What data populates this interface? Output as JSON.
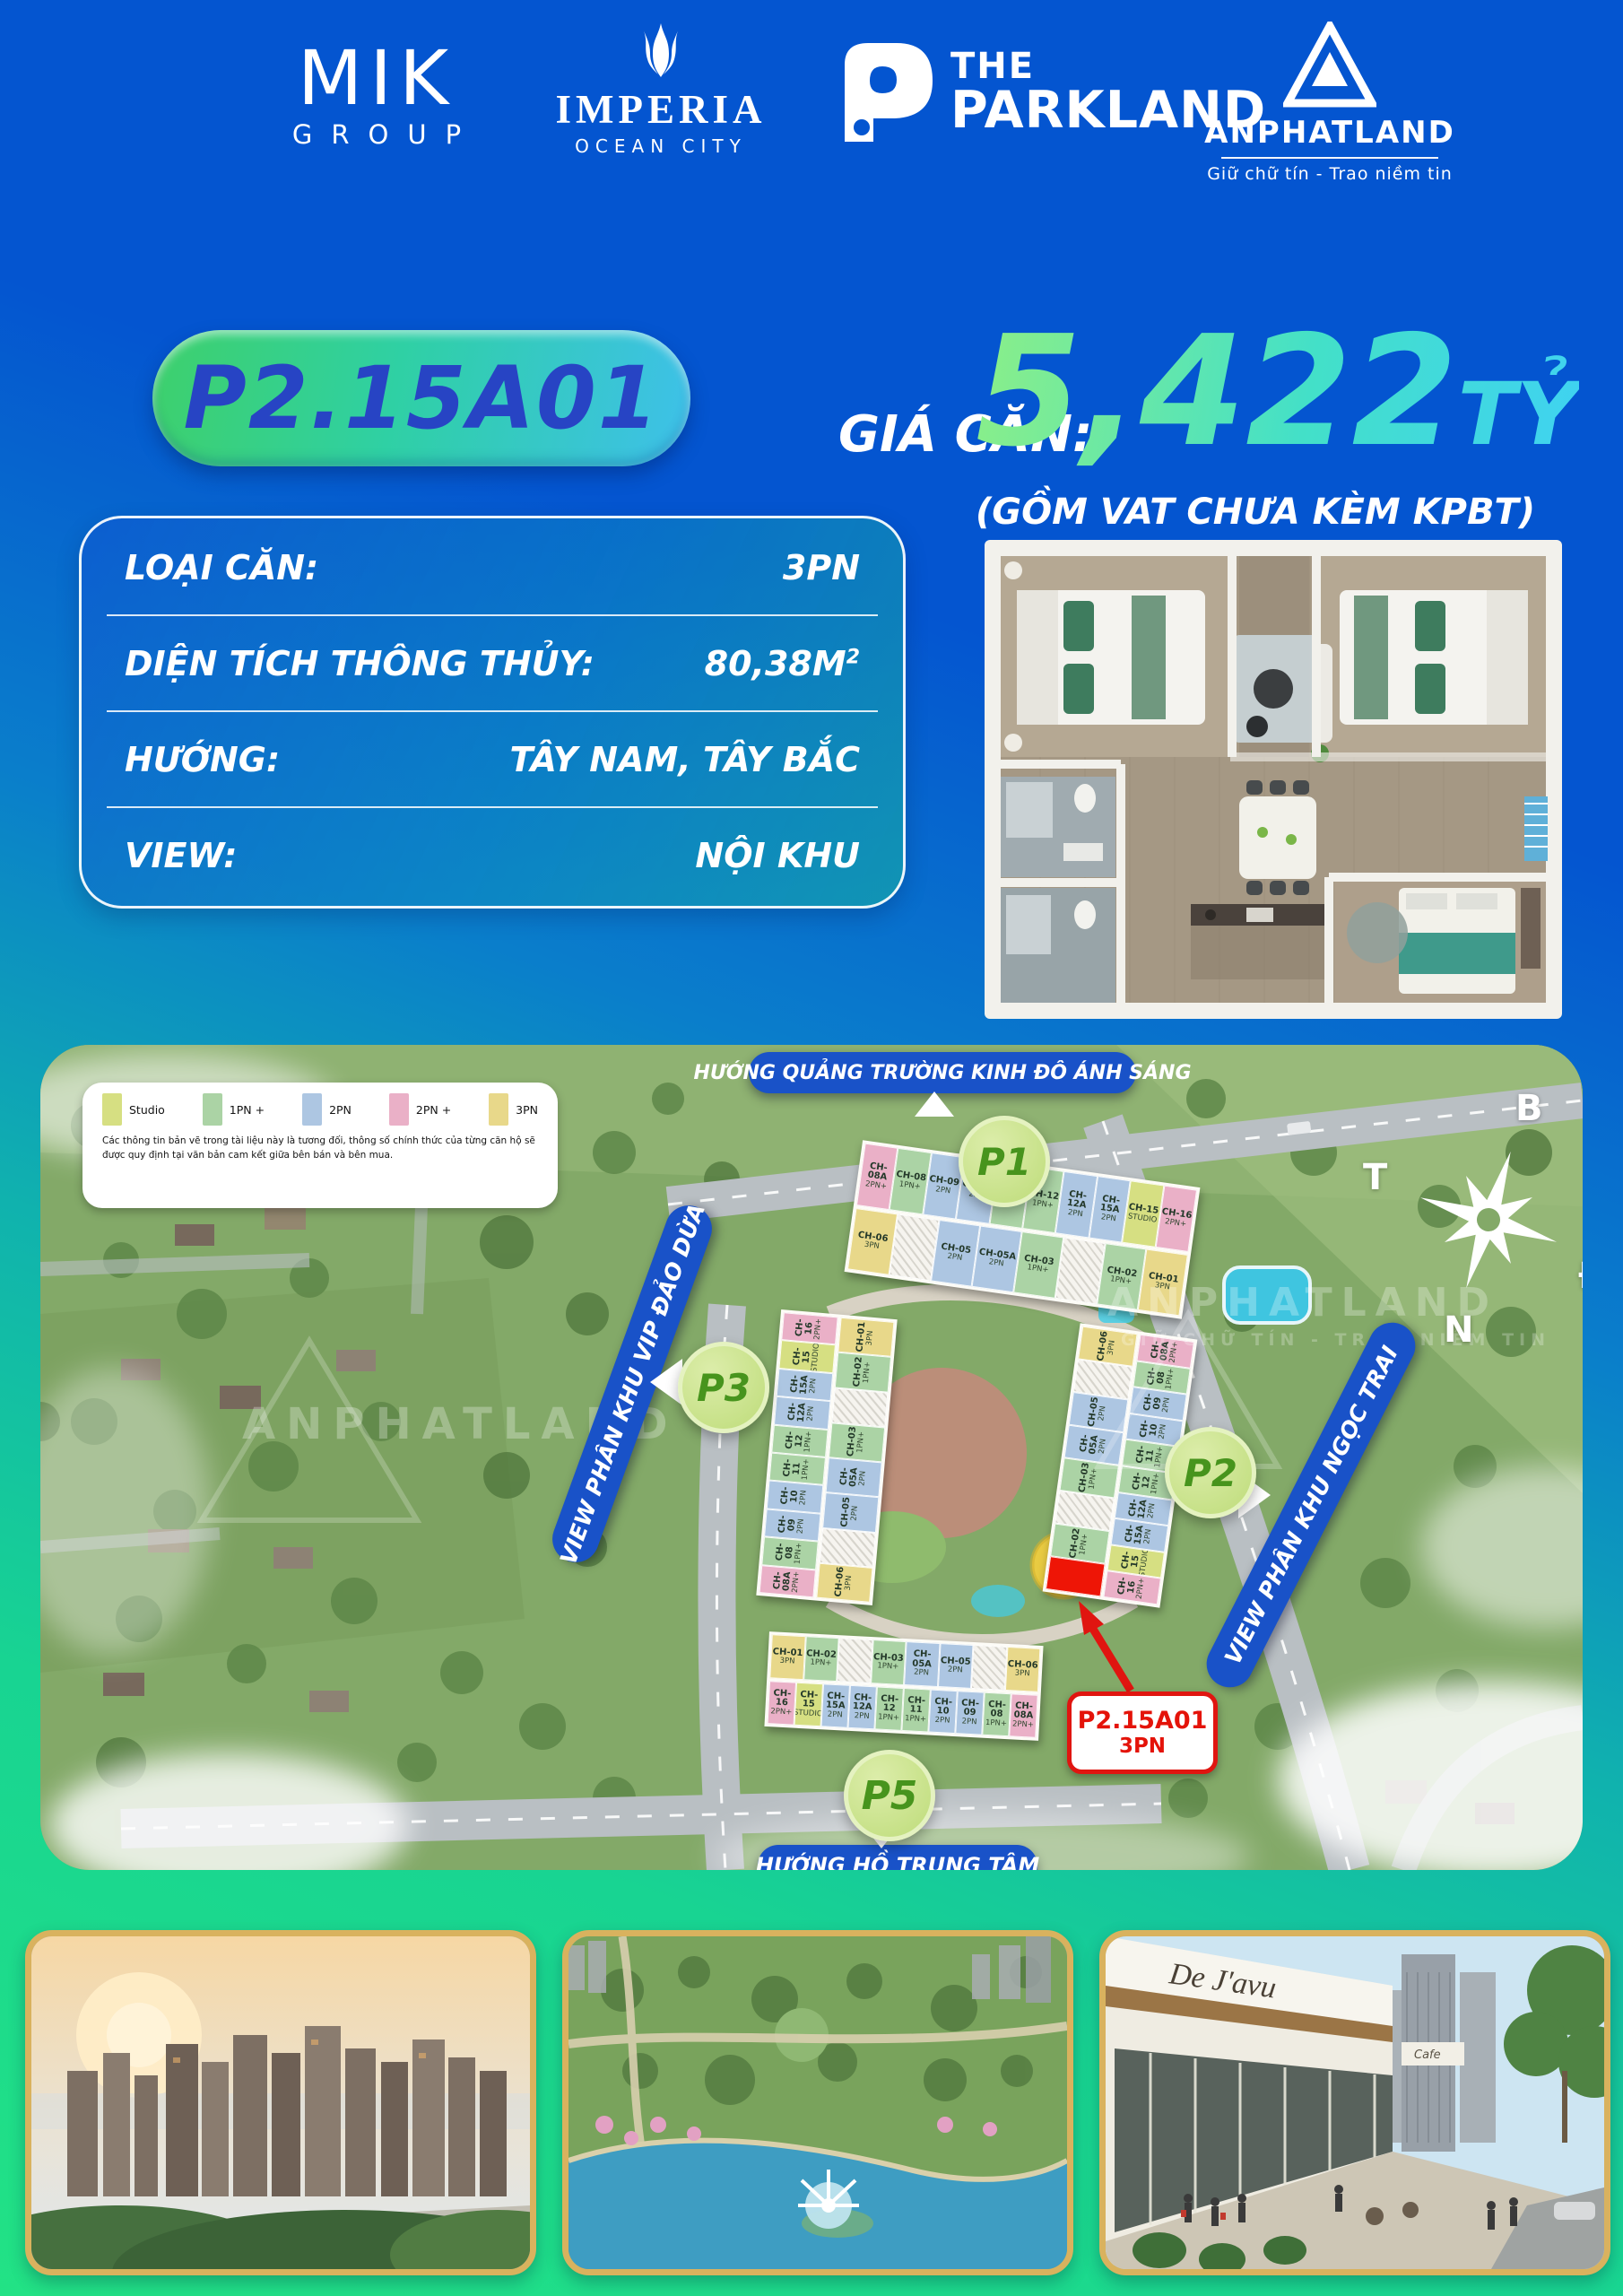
{
  "header": {
    "mik": {
      "line1": "MIK",
      "line2": "GROUP"
    },
    "imperia": {
      "name": "IMPERIA",
      "sub": "OCEAN CITY"
    },
    "parkland": {
      "line1": "THE",
      "line2": "PARKLAND"
    },
    "anphat": {
      "name": "ANPHATLAND",
      "tagline": "Giữ chữ tín  -  Trao niềm tin"
    }
  },
  "unit": {
    "code": "P2.15A01",
    "price_label": "GIÁ CĂN:",
    "price": "5,422",
    "price_unit": "TỶ",
    "price_note": "(GỒM VAT CHƯA KÈM KPBT)"
  },
  "details": {
    "rows": [
      {
        "label": "LOẠI CĂN:",
        "value": "3PN"
      },
      {
        "label": "DIỆN TÍCH THÔNG THỦY:",
        "value": "80,38M",
        "value_sup": "2"
      },
      {
        "label": "HƯỚNG:",
        "value": "TÂY NAM, TÂY BẮC"
      },
      {
        "label": "VIEW:",
        "value": "NỘI KHU"
      }
    ]
  },
  "map": {
    "banners": {
      "top": "HƯỚNG QUẢNG TRƯỜNG KINH ĐÔ ÁNH SÁNG",
      "bottom": "HƯỚNG HỒ TRUNG TÂM",
      "left": "VIEW PHÂN KHU VIP ĐẢO DỪA",
      "right": "VIEW PHÂN KHU NGỌC TRAI"
    },
    "legend": {
      "items": [
        {
          "label": "Studio",
          "color": "#d6df82"
        },
        {
          "label": "1PN +",
          "color": "#abd3a5"
        },
        {
          "label": "2PN",
          "color": "#adc6e2"
        },
        {
          "label": "2PN +",
          "color": "#eab0c7"
        },
        {
          "label": "3PN",
          "color": "#e8d88a"
        }
      ],
      "disclaimer": "Các thông tin bản vẽ trong tài liệu này là tương đối, thông số chính thức của từng căn hộ sẽ được quy định tại văn bản cam kết giữa bên bán và bên mua."
    },
    "compass": {
      "north": "B",
      "west": "T",
      "east": "Đ",
      "south": "N"
    },
    "watermark": {
      "text": "ANPHATLAND",
      "tagline": "GIỮ CHỮ TÍN - TRAO NIỀM TIN"
    },
    "callout": {
      "line1": "P2.15A01",
      "line2": "3PN"
    },
    "highlight_color": "#ee1506",
    "buildings": {
      "p1": {
        "badge": "P1",
        "orientation": "horizontal",
        "groups": [
          [
            {
              "code": "CH-08A",
              "type": "2PN+",
              "f": "2pnp"
            },
            {
              "code": "CH-08",
              "type": "1PN+",
              "f": "1pn"
            },
            {
              "code": "CH-09",
              "type": "2PN",
              "f": "2pn"
            },
            {
              "code": "CH-10",
              "type": "2PN",
              "f": "2pn"
            },
            {
              "code": "CH-11",
              "type": "1PN+",
              "f": "1pn"
            },
            {
              "code": "CH-12",
              "type": "1PN+",
              "f": "1pn"
            },
            {
              "code": "CH-12A",
              "type": "2PN",
              "f": "2pn"
            },
            {
              "code": "CH-15A",
              "type": "2PN",
              "f": "2pn"
            },
            {
              "code": "CH-15",
              "type": "STUDIO",
              "f": "studio"
            },
            {
              "code": "CH-16",
              "type": "2PN+",
              "f": "2pnp"
            }
          ],
          [
            {
              "code": "CH-06",
              "type": "3PN",
              "f": "3pn"
            },
            {
              "core": true
            },
            {
              "code": "CH-05",
              "type": "2PN",
              "f": "2pn"
            },
            {
              "code": "CH-05A",
              "type": "2PN",
              "f": "2pn"
            },
            {
              "code": "CH-03",
              "type": "1PN+",
              "f": "1pn"
            },
            {
              "core": true
            },
            {
              "code": "CH-02",
              "type": "1PN+",
              "f": "1pn"
            },
            {
              "code": "CH-01",
              "type": "3PN",
              "f": "3pn"
            }
          ]
        ]
      },
      "p3": {
        "badge": "P3",
        "orientation": "vertical",
        "groups": [
          [
            {
              "code": "CH-16",
              "type": "2PN+",
              "f": "2pnp"
            },
            {
              "code": "CH-15",
              "type": "STUDIO",
              "f": "studio"
            },
            {
              "code": "CH-15A",
              "type": "2PN",
              "f": "2pn"
            },
            {
              "code": "CH-12A",
              "type": "2PN",
              "f": "2pn"
            },
            {
              "code": "CH-12",
              "type": "1PN+",
              "f": "1pn"
            },
            {
              "code": "CH-11",
              "type": "1PN+",
              "f": "1pn"
            },
            {
              "code": "CH-10",
              "type": "2PN",
              "f": "2pn"
            },
            {
              "code": "CH-09",
              "type": "2PN",
              "f": "2pn"
            },
            {
              "code": "CH-08",
              "type": "1PN+",
              "f": "1pn"
            },
            {
              "code": "CH-08A",
              "type": "2PN+",
              "f": "2pnp"
            }
          ],
          [
            {
              "code": "CH-01",
              "type": "3PN",
              "f": "3pn"
            },
            {
              "code": "CH-02",
              "type": "1PN+",
              "f": "1pn"
            },
            {
              "core": true
            },
            {
              "code": "CH-03",
              "type": "1PN+",
              "f": "1pn"
            },
            {
              "code": "CH-05A",
              "type": "2PN",
              "f": "2pn"
            },
            {
              "code": "CH-05",
              "type": "2PN",
              "f": "2pn"
            },
            {
              "core": true
            },
            {
              "code": "CH-06",
              "type": "3PN",
              "f": "3pn"
            }
          ]
        ]
      },
      "p2": {
        "badge": "P2",
        "orientation": "vertical",
        "groups": [
          [
            {
              "code": "CH-06",
              "type": "3PN",
              "f": "3pn"
            },
            {
              "core": true
            },
            {
              "code": "CH-05",
              "type": "2PN",
              "f": "2pn"
            },
            {
              "code": "CH-05A",
              "type": "2PN",
              "f": "2pn"
            },
            {
              "code": "CH-03",
              "type": "1PN+",
              "f": "1pn"
            },
            {
              "core": true
            },
            {
              "code": "CH-02",
              "type": "1PN+",
              "f": "1pn"
            },
            {
              "code": "CH-01",
              "type": "3PN",
              "f": "red",
              "nolabel": true
            }
          ],
          [
            {
              "code": "CH-08A",
              "type": "2PN+",
              "f": "2pnp"
            },
            {
              "code": "CH-08",
              "type": "1PN+",
              "f": "1pn"
            },
            {
              "code": "CH-09",
              "type": "2PN",
              "f": "2pn"
            },
            {
              "code": "CH-10",
              "type": "2PN",
              "f": "2pn"
            },
            {
              "code": "CH-11",
              "type": "1PN+",
              "f": "1pn"
            },
            {
              "code": "CH-12",
              "type": "1PN+",
              "f": "1pn"
            },
            {
              "code": "CH-12A",
              "type": "2PN",
              "f": "2pn"
            },
            {
              "code": "CH-15A",
              "type": "2PN",
              "f": "2pn"
            },
            {
              "code": "CH-15",
              "type": "STUDIO",
              "f": "studio"
            },
            {
              "code": "CH-16",
              "type": "2PN+",
              "f": "2pnp"
            }
          ]
        ]
      },
      "p5": {
        "badge": "P5",
        "orientation": "horizontal",
        "groups": [
          [
            {
              "code": "CH-01",
              "type": "3PN",
              "f": "3pn"
            },
            {
              "code": "CH-02",
              "type": "1PN+",
              "f": "1pn"
            },
            {
              "core": true
            },
            {
              "code": "CH-03",
              "type": "1PN+",
              "f": "1pn"
            },
            {
              "code": "CH-05A",
              "type": "2PN",
              "f": "2pn"
            },
            {
              "code": "CH-05",
              "type": "2PN",
              "f": "2pn"
            },
            {
              "core": true
            },
            {
              "code": "CH-06",
              "type": "3PN",
              "f": "3pn"
            }
          ],
          [
            {
              "code": "CH-16",
              "type": "2PN+",
              "f": "2pnp"
            },
            {
              "code": "CH-15",
              "type": "STUDIO",
              "f": "studio"
            },
            {
              "code": "CH-15A",
              "type": "2PN",
              "f": "2pn"
            },
            {
              "code": "CH-12A",
              "type": "2PN",
              "f": "2pn"
            },
            {
              "code": "CH-12",
              "type": "1PN+",
              "f": "1pn"
            },
            {
              "code": "CH-11",
              "type": "1PN+",
              "f": "1pn"
            },
            {
              "code": "CH-10",
              "type": "2PN",
              "f": "2pn"
            },
            {
              "code": "CH-09",
              "type": "2PN",
              "f": "2pn"
            },
            {
              "code": "CH-08",
              "type": "1PN+",
              "f": "1pn"
            },
            {
              "code": "CH-08A",
              "type": "2PN+",
              "f": "2pnp"
            }
          ]
        ]
      }
    }
  },
  "photos": {
    "retail_sign": "De J'avu"
  }
}
